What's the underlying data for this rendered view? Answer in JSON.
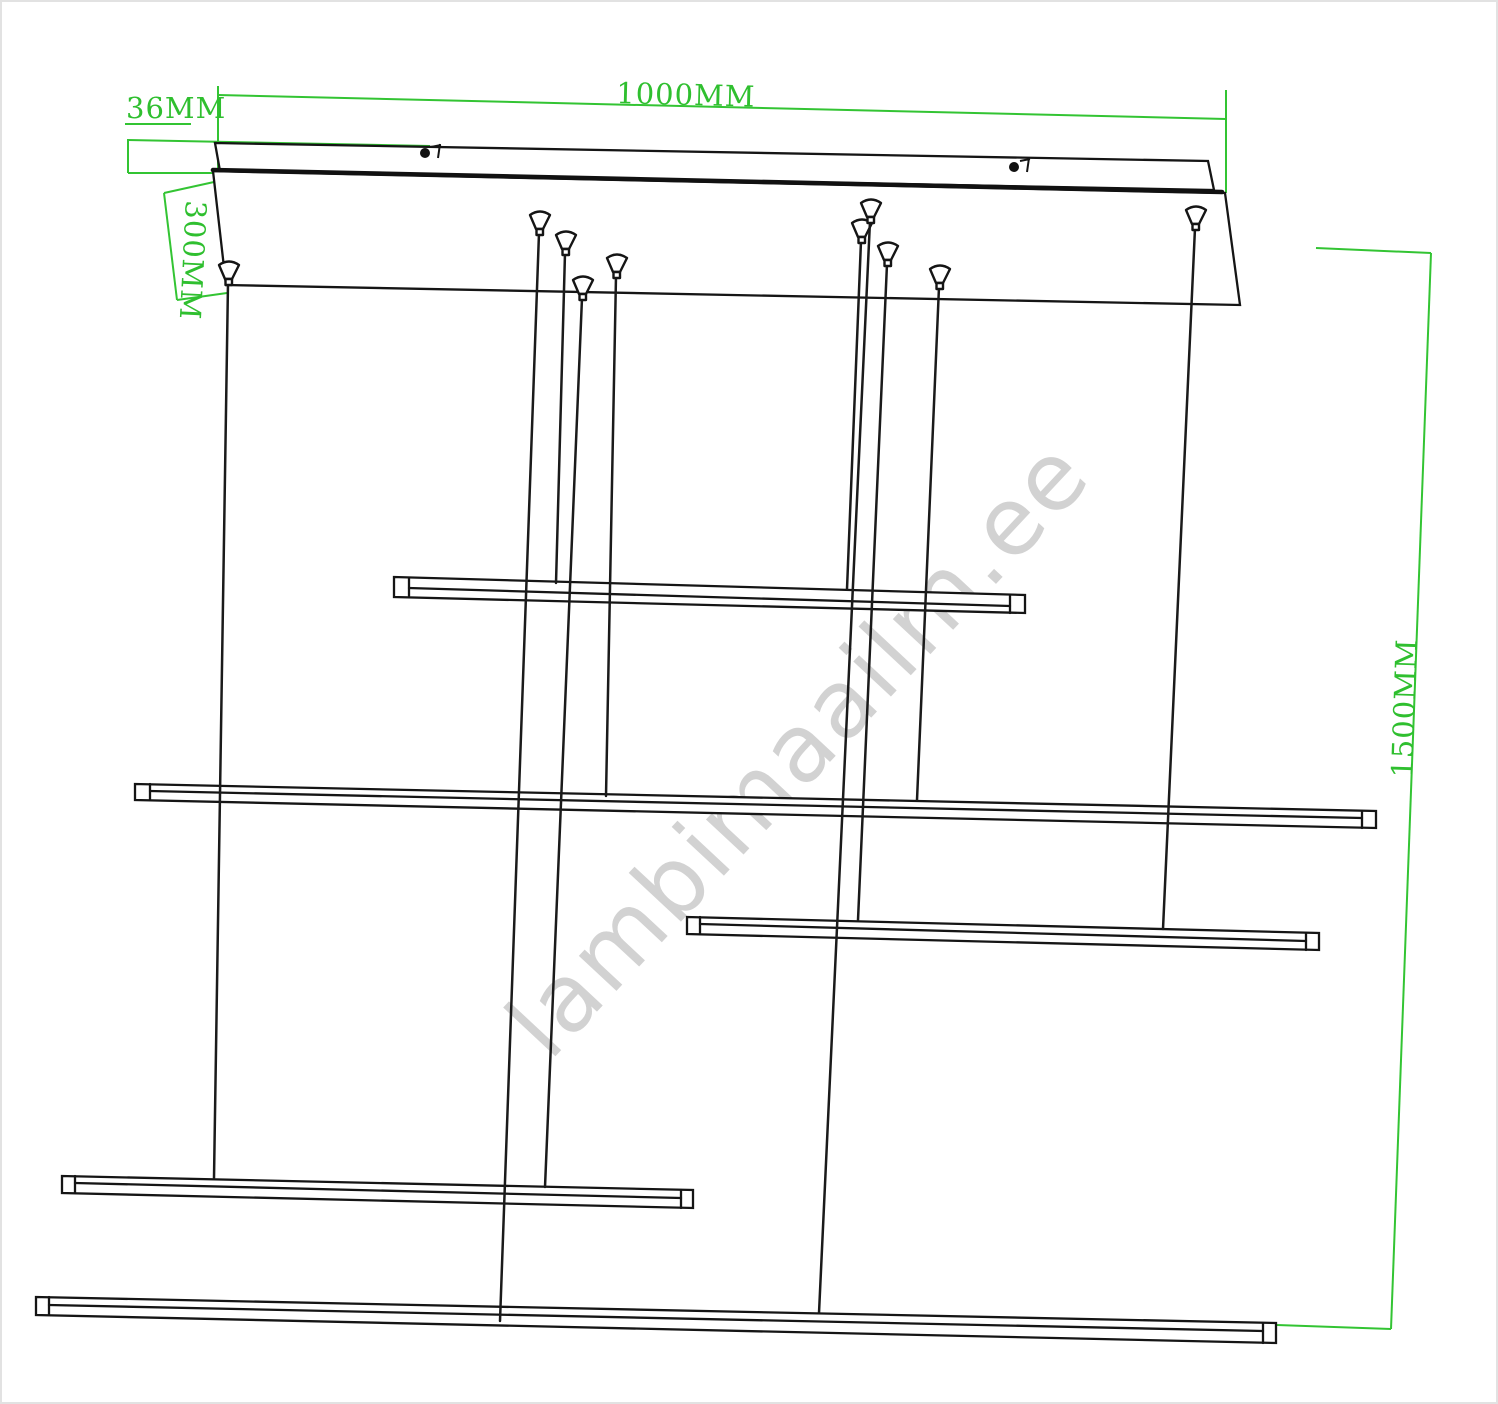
{
  "drawing": {
    "title": "pendant-light-suspension-technical-drawing",
    "dimensions": {
      "width": "1000MM",
      "canopy_thickness": "36MM",
      "canopy_depth": "300MM",
      "suspension_drop": "1500MM"
    },
    "watermark": "lambimaailm.ee",
    "colors": {
      "dimension_green": "#33c433",
      "line_black": "#151515",
      "watermark_gray": "#d2d2d2"
    },
    "counts": {
      "light_bars": 5,
      "suspension_wires": 10
    }
  }
}
